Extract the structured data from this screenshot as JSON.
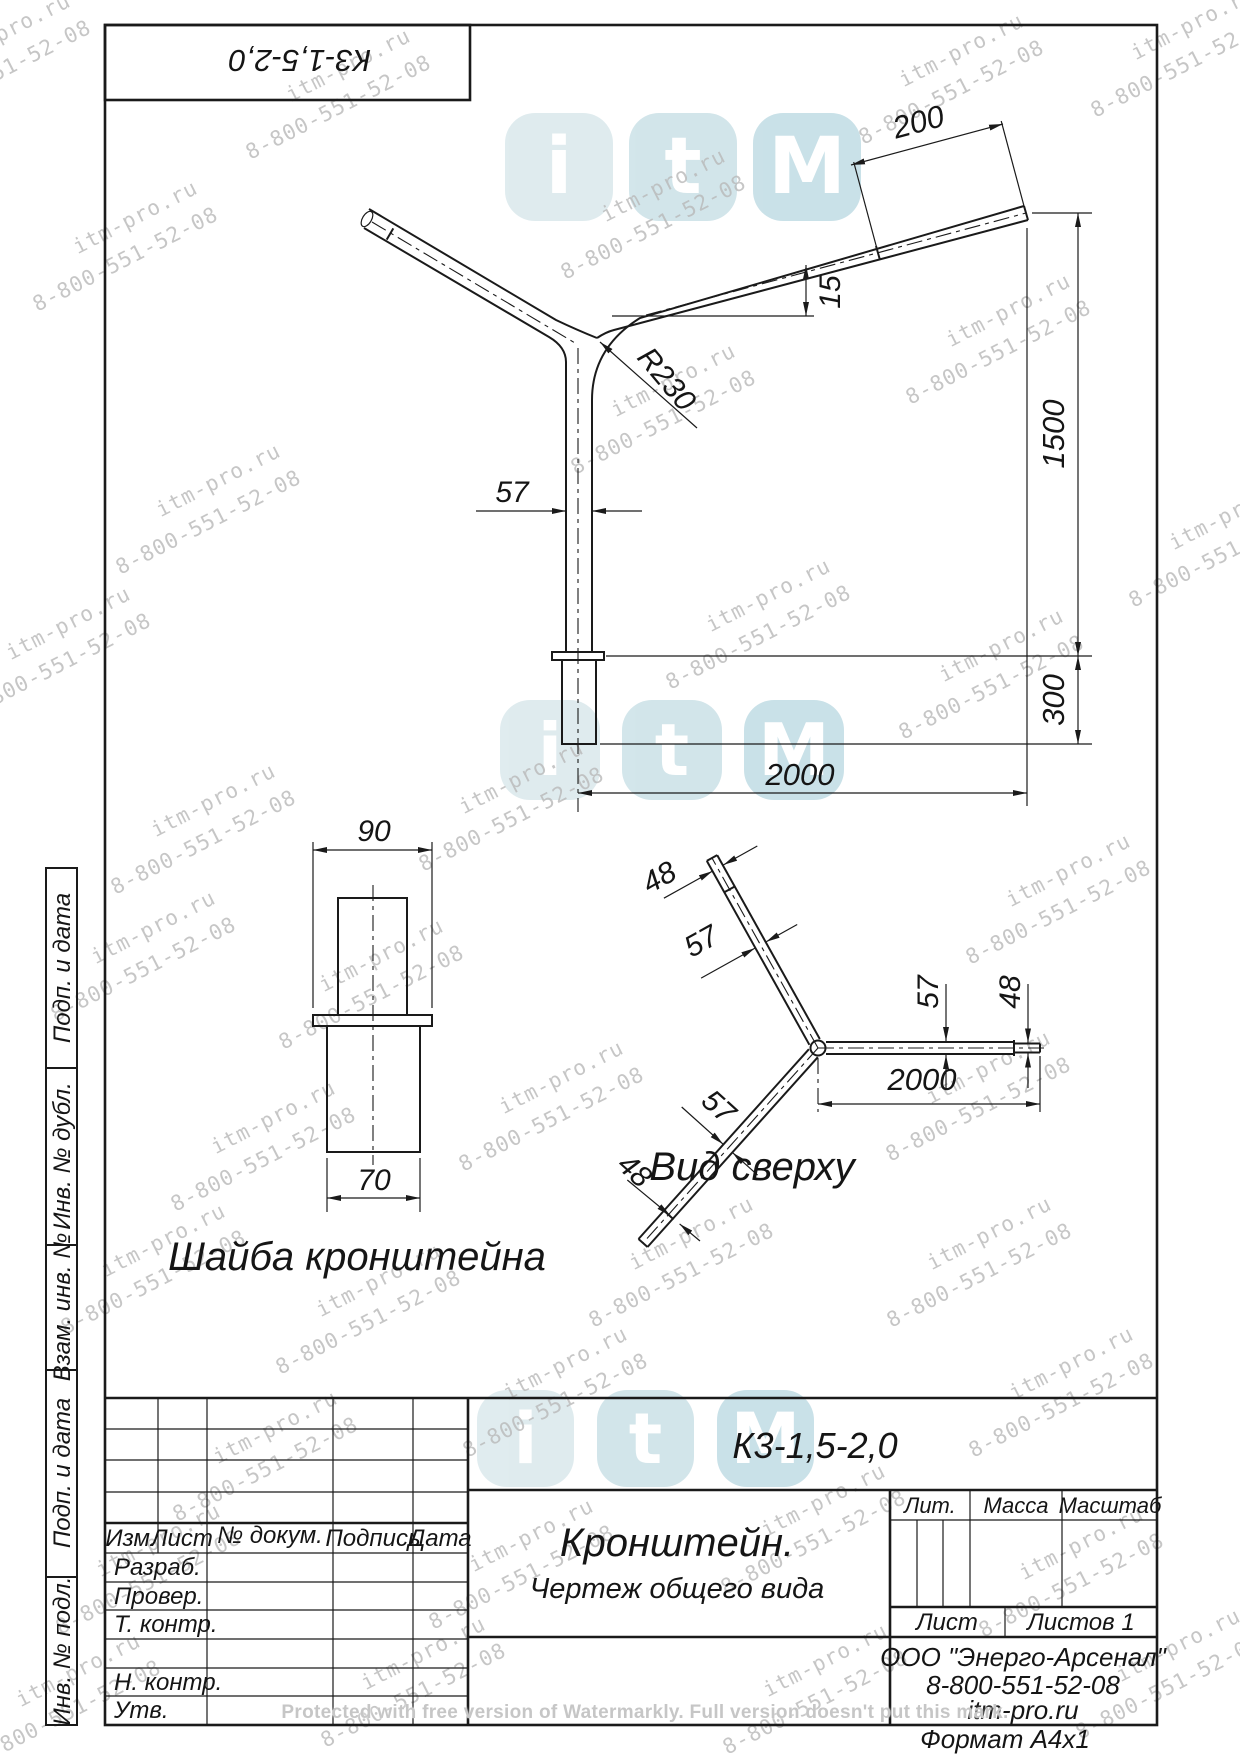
{
  "corner_stamp": {
    "text": "К3-1,5-2,0"
  },
  "front_view": {
    "dim_200": "200",
    "dim_15": "15",
    "dim_1500": "1500",
    "dim_300": "300",
    "dim_2000": "2000",
    "dim_57": "57",
    "radius": "R230"
  },
  "washer_view": {
    "dim_90": "90",
    "dim_70": "70",
    "caption": "Шайба кронштейна"
  },
  "top_view": {
    "caption": "Вид сверху",
    "dim_48_upper": "48",
    "dim_57_upper": "57",
    "dim_57_right": "57",
    "dim_48_right": "48",
    "dim_2000": "2000",
    "dim_57_lower": "57",
    "dim_48_lower": "48"
  },
  "side_column": {
    "cells": [
      "Подп. и дата",
      "Инв. № дубл.",
      "Взам. инв. №",
      "Подп. и дата",
      "Инв. № подл."
    ]
  },
  "title_block": {
    "designation": "К3-1,5-2,0",
    "name_line1": "Кронштейн.",
    "name_line2": "Чертеж общего вида",
    "rev_headers": [
      "Изм.",
      "Лист",
      "№ докум.",
      "Подпись",
      "Дата"
    ],
    "sig_rows": [
      "Разраб.",
      "Провер.",
      "Т. контр.",
      "Н. контр.",
      "Утв."
    ],
    "lit_label": "Лит.",
    "massa_label": "Масса",
    "masshtab_label": "Масштаб",
    "list_label": "Лист",
    "listov_label": "Листов 1",
    "company_line1": "ООО \"Энерго-Арсенал\"",
    "company_line2": "8-800-551-52-08",
    "company_line3": "itm-pro.ru",
    "format_label": "Формат  А4х1"
  },
  "watermark": {
    "line1": "itm-pro.ru",
    "line2": "8-800-551-52-08",
    "positions": [
      [
        -115,
        75
      ],
      [
        225,
        110
      ],
      [
        540,
        230
      ],
      [
        838,
        95
      ],
      [
        1070,
        68
      ],
      [
        12,
        262
      ],
      [
        885,
        355
      ],
      [
        95,
        525
      ],
      [
        550,
        425
      ],
      [
        -55,
        668
      ],
      [
        645,
        640
      ],
      [
        878,
        690
      ],
      [
        1108,
        558
      ],
      [
        90,
        845
      ],
      [
        398,
        822
      ],
      [
        945,
        915
      ],
      [
        30,
        972
      ],
      [
        258,
        1000
      ],
      [
        438,
        1122
      ],
      [
        150,
        1162
      ],
      [
        865,
        1112
      ],
      [
        40,
        1285
      ],
      [
        255,
        1325
      ],
      [
        568,
        1278
      ],
      [
        866,
        1278
      ],
      [
        152,
        1472
      ],
      [
        442,
        1408
      ],
      [
        948,
        1408
      ],
      [
        35,
        1585
      ],
      [
        408,
        1580
      ],
      [
        700,
        1545
      ],
      [
        958,
        1588
      ],
      [
        300,
        1698
      ],
      [
        702,
        1705
      ],
      [
        1055,
        1690
      ],
      [
        -45,
        1715
      ]
    ]
  },
  "logos": {
    "letters": [
      "i",
      "t",
      "M"
    ],
    "rows": [
      [
        505,
        113,
        108,
        16
      ],
      [
        500,
        700,
        100,
        22
      ],
      [
        477,
        1390,
        97,
        23
      ]
    ],
    "tile_colors": [
      "#cde0e5",
      "#b8d6de",
      "#a9cfda"
    ]
  },
  "notice": {
    "text": "Protected with free version of Watermarkly. Full version doesn't put this mark."
  },
  "colors": {
    "line": "#1a1a1a",
    "watermark_text": "#b9b9b9",
    "logo_letter": "#ffffff"
  }
}
